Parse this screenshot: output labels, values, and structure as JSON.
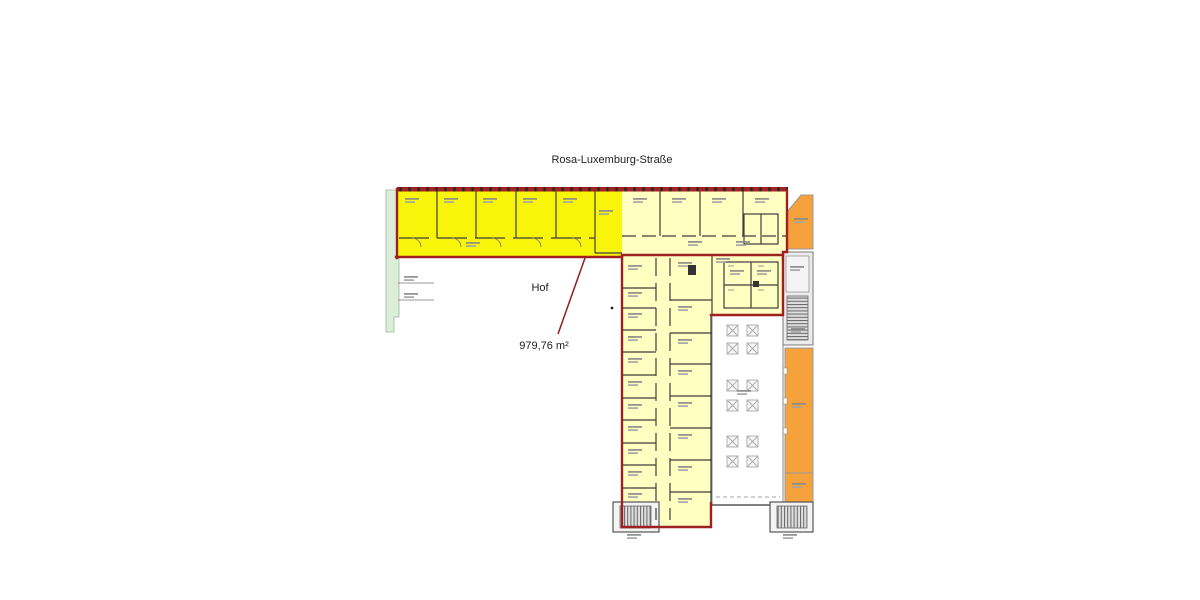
{
  "labels": {
    "street": "Rosa-Luxemburg-Straße",
    "courtyard": "Hof",
    "area": "979,76 m²"
  },
  "legend_colors": {
    "highlighted_rental_area": "#f9f50a",
    "building_area": "#ffffc2",
    "adjacent_building": "#f5a23d",
    "green_strip": "#dcedda",
    "boundary_red": "#9e2020"
  },
  "hall_columns": {
    "cols": [
      727,
      747
    ],
    "rows": [
      325,
      343,
      380,
      400,
      436,
      456
    ],
    "size": 11
  }
}
